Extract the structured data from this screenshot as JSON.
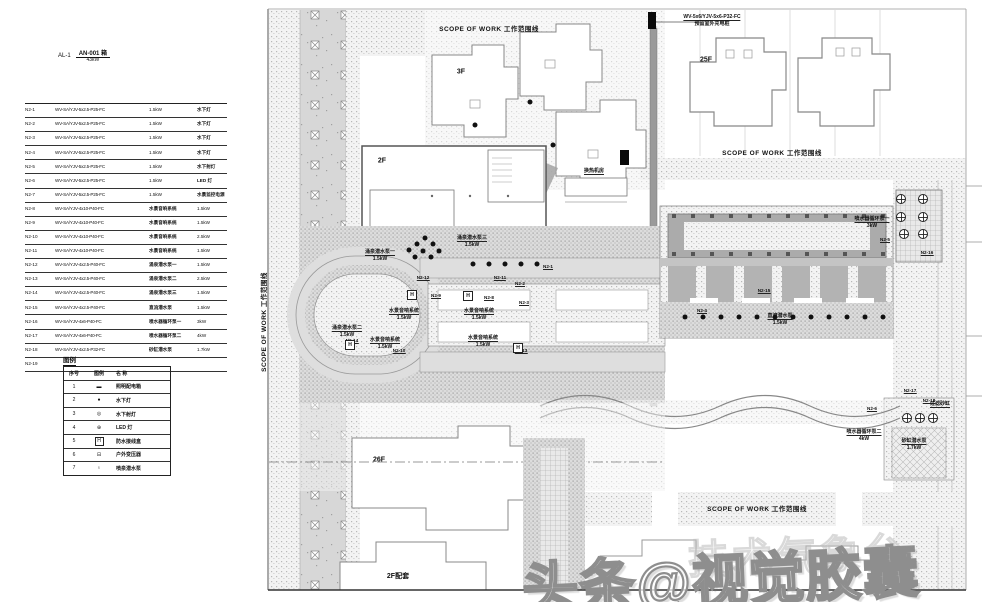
{
  "header_note": {
    "panel_id": "AL-1",
    "box_ref": "AN-001 箱",
    "power": "43kW"
  },
  "feeder_table": {
    "rows": [
      {
        "circuit": "N2-1",
        "spec": "WV-SA/YJV-5x2.5-P25-FC",
        "mid": "1.5kW",
        "right": "水下灯"
      },
      {
        "circuit": "N2-2",
        "spec": "WV-SA/YJV-5x2.5-P25-FC",
        "mid": "1.5kW",
        "right": "水下灯"
      },
      {
        "circuit": "N2-3",
        "spec": "WV-SA/YJV-5x2.5-P25-FC",
        "mid": "1.5kW",
        "right": "水下灯"
      },
      {
        "circuit": "N2-4",
        "spec": "WV-SA/YJV-5x2.5-P25-FC",
        "mid": "1.5kW",
        "right": "水下灯"
      },
      {
        "circuit": "N2-5",
        "spec": "WV-SA/YJV-5x2.5-P25-FC",
        "mid": "1.5kW",
        "right": "水下射灯"
      },
      {
        "circuit": "N2-6",
        "spec": "WV-SA/YJV-5x2.5-P25-FC",
        "mid": "1.5kW",
        "right": "LED 灯"
      },
      {
        "circuit": "N2-7",
        "spec": "WV-SA/YJV-5x2.5-P25-FC",
        "mid": "1.5kW",
        "right": "水景监控电源"
      },
      {
        "circuit": "N2-8",
        "spec": "WV-SA/YJV-4x10-P40-FC",
        "mid": "水景音响系统",
        "right": "1.5kW"
      },
      {
        "circuit": "N2-9",
        "spec": "WV-SA/YJV-4x10-P40-FC",
        "mid": "水景音响系统",
        "right": "1.5kW"
      },
      {
        "circuit": "N2-10",
        "spec": "WV-SA/YJV-4x10-P40-FC",
        "mid": "水景音响系统",
        "right": "2.5kW"
      },
      {
        "circuit": "N2-11",
        "spec": "WV-SA/YJV-4x10-P40-FC",
        "mid": "水景音响系统",
        "right": "1.5kW"
      },
      {
        "circuit": "N2-12",
        "spec": "WV-SA/YJV-4x2.5-P40-FC",
        "mid": "涌泉潜水泵一",
        "right": "1.5kW"
      },
      {
        "circuit": "N2-13",
        "spec": "WV-SA/YJV-4x2.5-P40-FC",
        "mid": "涌泉潜水泵二",
        "right": "2.5kW"
      },
      {
        "circuit": "N2-14",
        "spec": "WV-SA/YJV-4x2.5-P40-FC",
        "mid": "涌泉潜水泵三",
        "right": "1.5kW"
      },
      {
        "circuit": "N2-15",
        "spec": "WV-SA/YJV-4x2.5-P40-FC",
        "mid": "直流潜水泵",
        "right": "1.5kW"
      },
      {
        "circuit": "N2-16",
        "spec": "WV-SA/YJV-4x6-P40-FC",
        "mid": "喷水器循环泵一",
        "right": "3kW"
      },
      {
        "circuit": "N2-17",
        "spec": "WV-SA/YJV-4x6-P40-FC",
        "mid": "喷水器循环泵二",
        "right": "4kW"
      },
      {
        "circuit": "N2-18",
        "spec": "WV-SA/YJV-4x2.5-P32-FC",
        "mid": "砂缸潜水泵",
        "right": "1.7kW"
      },
      {
        "circuit": "N2-19",
        "spec": "",
        "mid": "",
        "right": ""
      }
    ]
  },
  "legend": {
    "title": "图例",
    "headers": [
      "序号",
      "图例",
      "名 称"
    ],
    "rows": [
      {
        "no": "1",
        "symbol": "bar",
        "name": "照明配电箱"
      },
      {
        "no": "2",
        "symbol": "dot",
        "name": "水下灯"
      },
      {
        "no": "3",
        "symbol": "spot",
        "name": "水下射灯"
      },
      {
        "no": "4",
        "symbol": "led",
        "name": "LED 灯"
      },
      {
        "no": "5",
        "symbol": "junction",
        "name": "防水接线盒"
      },
      {
        "no": "6",
        "symbol": "transformer",
        "name": "户外变压器"
      },
      {
        "no": "7",
        "symbol": "pump",
        "name": "喷泉潜水泵"
      }
    ]
  },
  "plan": {
    "scope_labels": [
      {
        "x": 489,
        "y": 28,
        "text": "SCOPE OF WORK 工作范围线",
        "rot": 0
      },
      {
        "x": 772,
        "y": 152,
        "text": "SCOPE OF WORK 工作范围线",
        "rot": 0
      },
      {
        "x": 757,
        "y": 508,
        "text": "SCOPE OF WORK 工作范围线",
        "rot": 0
      },
      {
        "x": 263,
        "y": 322,
        "text": "SCOPE OF WORK 工作范围线",
        "rot": -90
      }
    ],
    "building_labels": [
      {
        "x": 706,
        "y": 60,
        "text": "25F"
      },
      {
        "x": 461,
        "y": 72,
        "text": "3F"
      },
      {
        "x": 382,
        "y": 161,
        "text": "2F"
      },
      {
        "x": 379,
        "y": 460,
        "text": "26F"
      },
      {
        "x": 398,
        "y": 576,
        "text": "2F配套"
      },
      {
        "x": 589,
        "y": 574,
        "text": "26F"
      }
    ],
    "callouts": [
      {
        "x": 712,
        "y": 14,
        "lines": [
          "WV-5x6/YJV-5x6-P32-FC",
          "预留室外充电桩"
        ]
      },
      {
        "x": 594,
        "y": 168,
        "lines": [
          "换热机房"
        ]
      },
      {
        "x": 380,
        "y": 249,
        "lines": [
          "涌泉潜水泵一",
          "1.5kW"
        ]
      },
      {
        "x": 347,
        "y": 325,
        "lines": [
          "涌泉潜水泵二",
          "1.5kW"
        ]
      },
      {
        "x": 472,
        "y": 235,
        "lines": [
          "涌泉潜水泵三",
          "1.5kW"
        ]
      },
      {
        "x": 404,
        "y": 308,
        "lines": [
          "水景音响系统",
          "1.5kW"
        ]
      },
      {
        "x": 479,
        "y": 308,
        "lines": [
          "水景音响系统",
          "1.5kW"
        ]
      },
      {
        "x": 385,
        "y": 337,
        "lines": [
          "水景音响系统",
          "1.5kW"
        ]
      },
      {
        "x": 483,
        "y": 335,
        "lines": [
          "水景音响系统",
          "1.5kW"
        ]
      },
      {
        "x": 780,
        "y": 313,
        "lines": [
          "直流潜水泵",
          "1.5kW"
        ]
      },
      {
        "x": 872,
        "y": 216,
        "lines": [
          "喷水器循环泵一",
          "3kW"
        ]
      },
      {
        "x": 864,
        "y": 429,
        "lines": [
          "喷水器循环泵二",
          "4kW"
        ]
      },
      {
        "x": 914,
        "y": 438,
        "lines": [
          "砂缸潜水泵",
          "1.7kW"
        ]
      },
      {
        "x": 940,
        "y": 401,
        "lines": [
          "过滤砂缸"
        ]
      }
    ],
    "tags": [
      {
        "x": 423,
        "y": 275,
        "text": "N2-12"
      },
      {
        "x": 500,
        "y": 275,
        "text": "N2-11"
      },
      {
        "x": 520,
        "y": 281,
        "text": "N2-2"
      },
      {
        "x": 436,
        "y": 293,
        "text": "N2-9"
      },
      {
        "x": 489,
        "y": 295,
        "text": "N2-8"
      },
      {
        "x": 524,
        "y": 300,
        "text": "N2-3"
      },
      {
        "x": 399,
        "y": 348,
        "text": "N2-10"
      },
      {
        "x": 521,
        "y": 348,
        "text": "N2-13"
      },
      {
        "x": 548,
        "y": 264,
        "text": "N2-1"
      },
      {
        "x": 352,
        "y": 338,
        "text": "N2-14"
      },
      {
        "x": 764,
        "y": 288,
        "text": "N2-15"
      },
      {
        "x": 702,
        "y": 308,
        "text": "N2-4"
      },
      {
        "x": 885,
        "y": 237,
        "text": "N2-5"
      },
      {
        "x": 927,
        "y": 250,
        "text": "N2-16"
      },
      {
        "x": 910,
        "y": 388,
        "text": "N2-17"
      },
      {
        "x": 929,
        "y": 398,
        "text": "N2-18"
      },
      {
        "x": 872,
        "y": 406,
        "text": "N2-6"
      }
    ],
    "junction_boxes": [
      {
        "x": 412,
        "y": 295
      },
      {
        "x": 468,
        "y": 296
      },
      {
        "x": 350,
        "y": 345
      },
      {
        "x": 518,
        "y": 348
      }
    ],
    "lights": [
      {
        "x": 409,
        "y": 250
      },
      {
        "x": 417,
        "y": 244
      },
      {
        "x": 425,
        "y": 238
      },
      {
        "x": 433,
        "y": 244
      },
      {
        "x": 415,
        "y": 257
      },
      {
        "x": 423,
        "y": 251
      },
      {
        "x": 431,
        "y": 257
      },
      {
        "x": 439,
        "y": 251
      },
      {
        "x": 473,
        "y": 264
      },
      {
        "x": 489,
        "y": 264
      },
      {
        "x": 505,
        "y": 264
      },
      {
        "x": 521,
        "y": 264
      },
      {
        "x": 537,
        "y": 264
      },
      {
        "x": 685,
        "y": 317
      },
      {
        "x": 703,
        "y": 317
      },
      {
        "x": 721,
        "y": 317
      },
      {
        "x": 739,
        "y": 317
      },
      {
        "x": 757,
        "y": 317
      },
      {
        "x": 775,
        "y": 317
      },
      {
        "x": 793,
        "y": 317
      },
      {
        "x": 811,
        "y": 317
      },
      {
        "x": 829,
        "y": 317
      },
      {
        "x": 847,
        "y": 317
      },
      {
        "x": 865,
        "y": 317
      },
      {
        "x": 883,
        "y": 317
      },
      {
        "x": 530,
        "y": 102
      },
      {
        "x": 475,
        "y": 125
      },
      {
        "x": 553,
        "y": 145
      }
    ],
    "pumps": [
      {
        "x": 901,
        "y": 199
      },
      {
        "x": 923,
        "y": 199
      },
      {
        "x": 901,
        "y": 217
      },
      {
        "x": 923,
        "y": 217
      },
      {
        "x": 904,
        "y": 234
      },
      {
        "x": 923,
        "y": 234
      },
      {
        "x": 907,
        "y": 418
      },
      {
        "x": 920,
        "y": 418
      },
      {
        "x": 933,
        "y": 418
      }
    ],
    "equipment_boxes": [
      {
        "x": 620,
        "y": 150,
        "w": 9,
        "h": 15
      },
      {
        "x": 648,
        "y": 12,
        "w": 8,
        "h": 17
      }
    ]
  },
  "watermark": {
    "main": "头条@视觉胶囊",
    "secondary": "技术气象台"
  },
  "colors": {
    "line": "#555555",
    "hatch": "#bbbbbb",
    "road": "#dedede",
    "dark": "#111111"
  }
}
